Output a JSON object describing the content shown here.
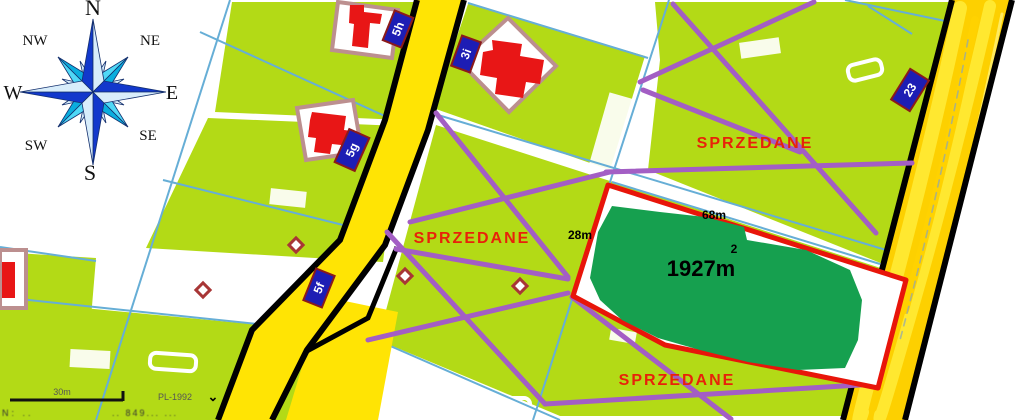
{
  "compass": {
    "n": "N",
    "ne": "NE",
    "e": "E",
    "se": "SE",
    "s": "S",
    "sw": "SW",
    "w": "W",
    "nw": "NW"
  },
  "parcel_labels": {
    "l5h": "5h",
    "l3i": "3i",
    "l5g": "5g",
    "l5f": "5f",
    "l23": "23"
  },
  "sold_label": "SPRZEDANE",
  "highlight_plot": {
    "area": "1927m",
    "area_exponent": "2",
    "top_edge_length": "68m",
    "left_edge_length": "28m"
  },
  "footer": {
    "scale_label": "30m",
    "crs_label": "PL-1992",
    "chevron": "⌄",
    "coord_left": "N: ..",
    "coord_right": ".. 849... ..."
  },
  "colors": {
    "parcel_green": "#b3da16",
    "highlight_green": "#16a04f",
    "road_yellow": "#ffdf00",
    "sold_red": "#e8220a",
    "boundary_red": "#e8150a",
    "purple": "#a35ec4",
    "cyan_line": "#66aed6",
    "label_navy": "#1d1db4",
    "building_red": "#e81616",
    "outline_rosy": "#bc8f8f"
  }
}
